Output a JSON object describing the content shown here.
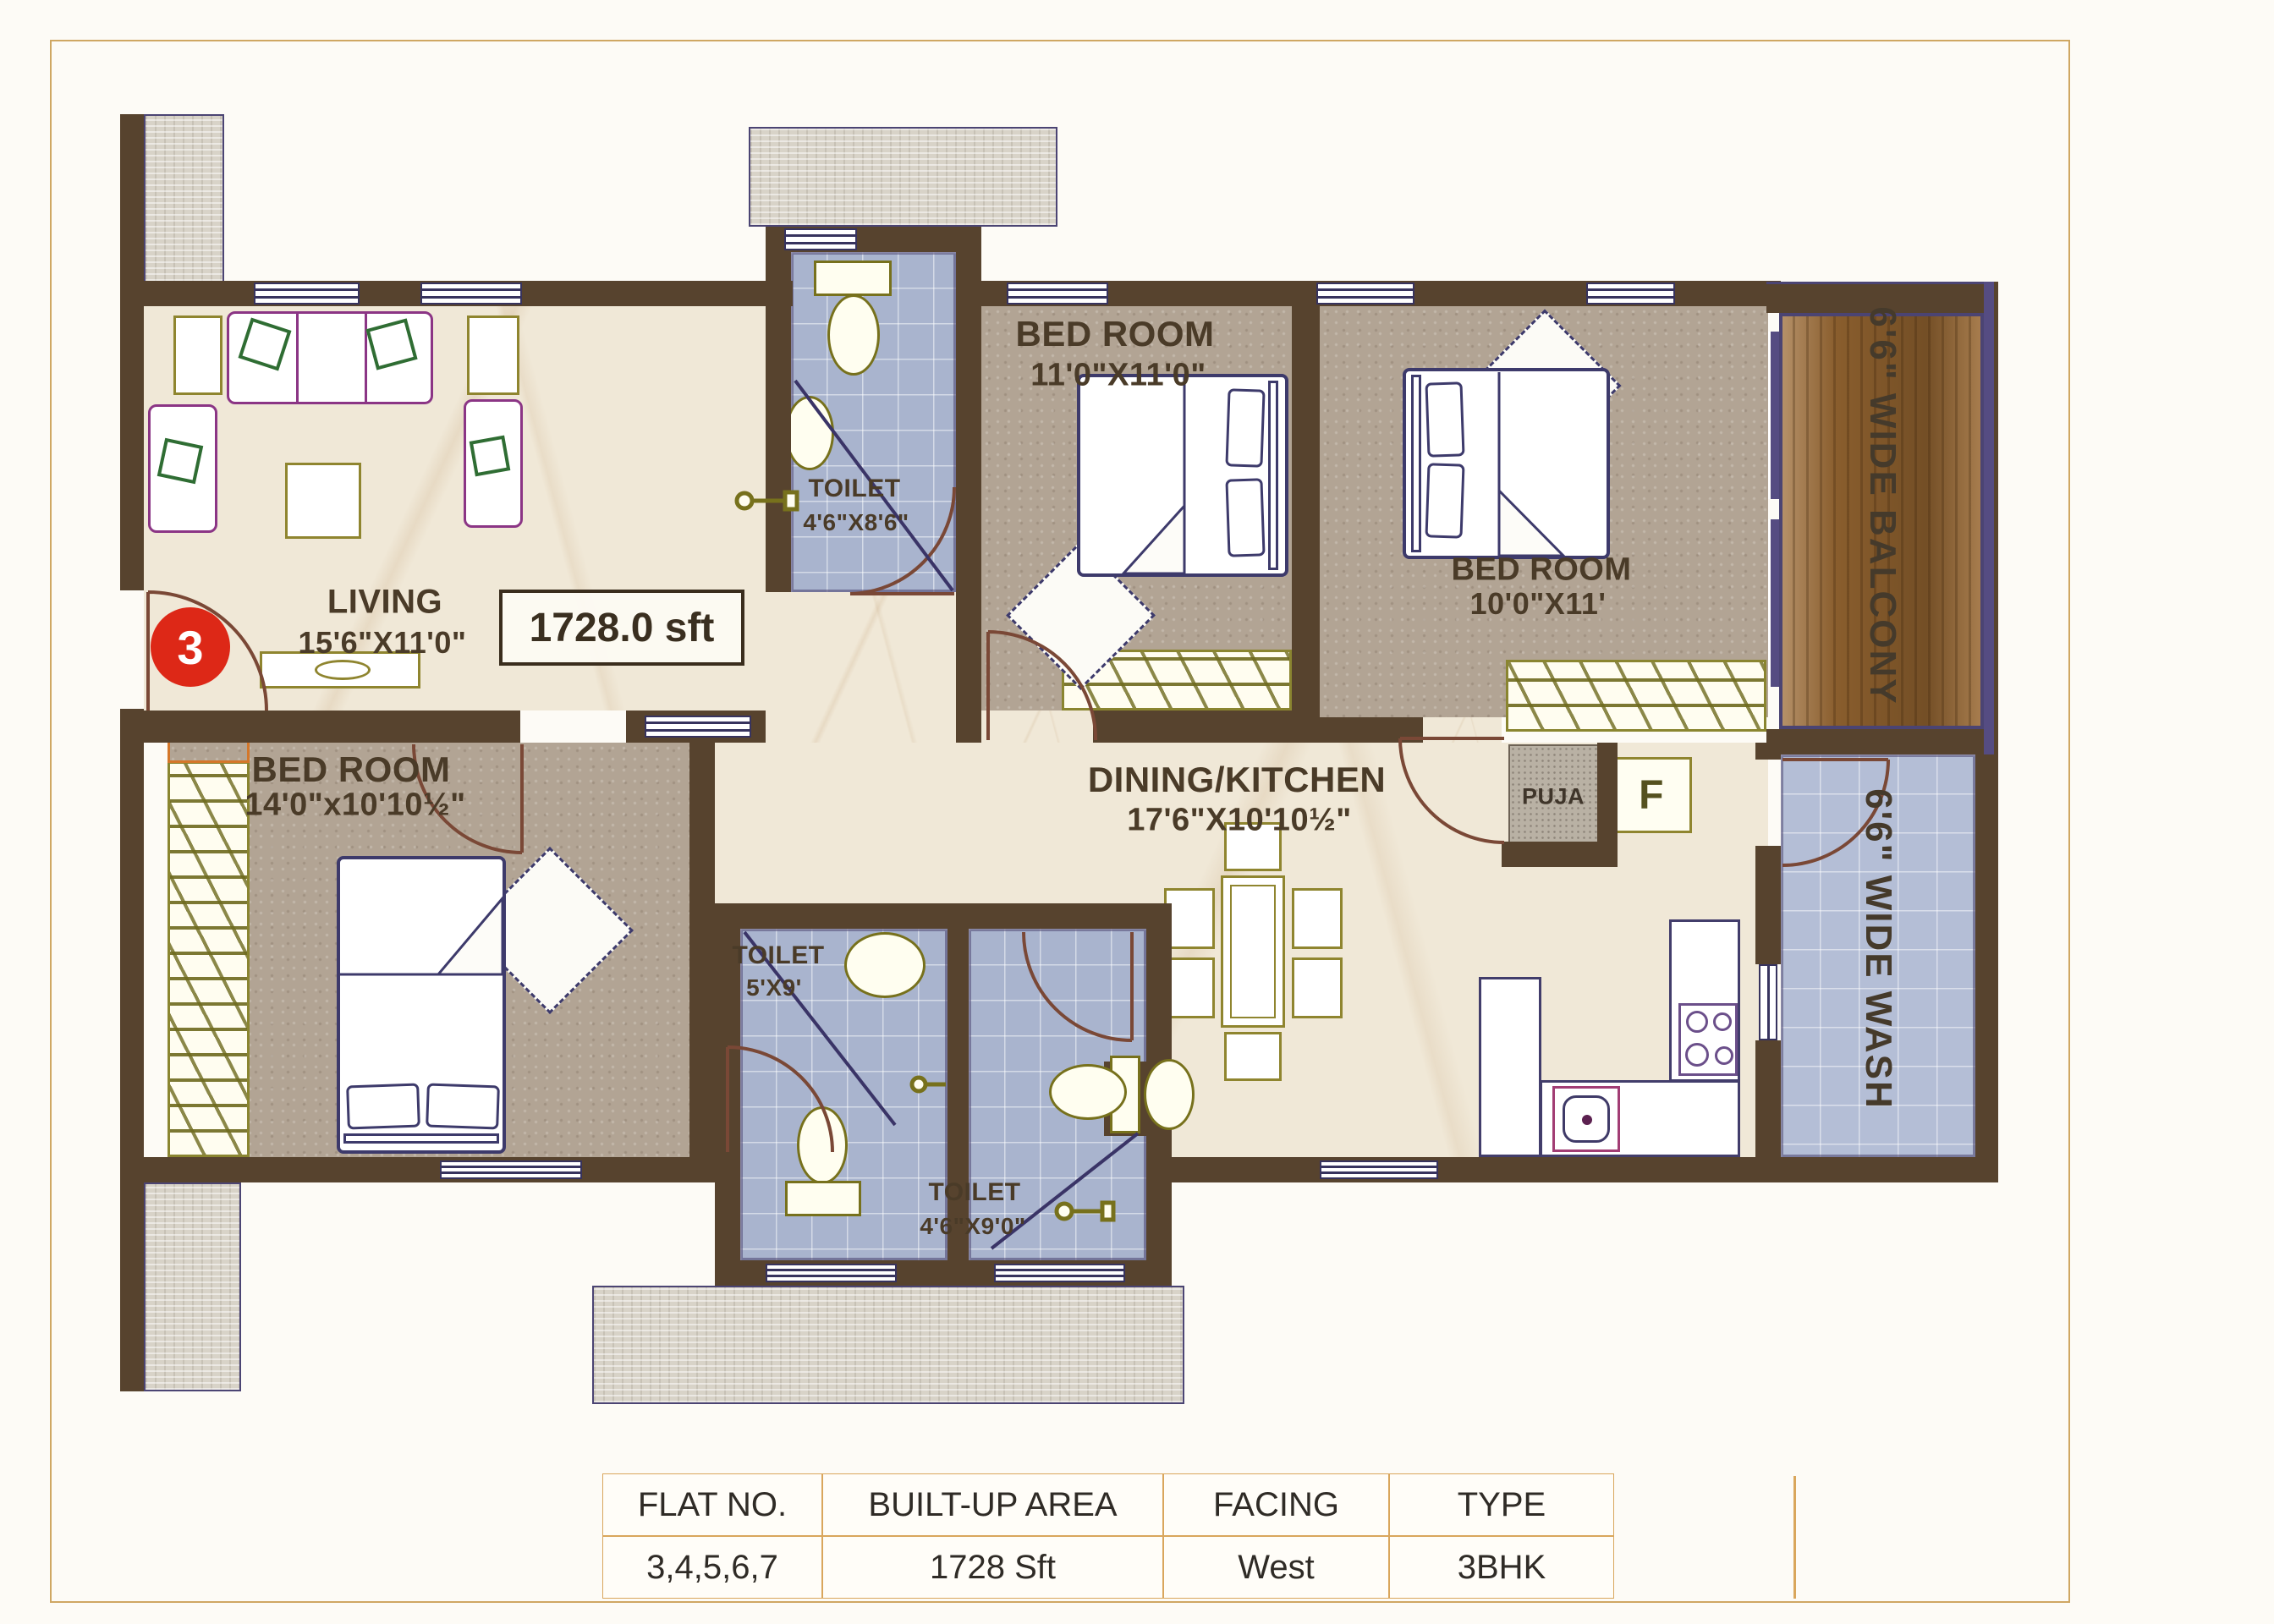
{
  "plan": {
    "badge": "3",
    "area": "1728.0 sft",
    "rooms": [
      {
        "id": "living",
        "name": "LIVING",
        "dims": "15'6\"X11'0\""
      },
      {
        "id": "bedroom-top",
        "name": "BED ROOM",
        "dims": "11'0\"X11'0\""
      },
      {
        "id": "bedroom-right",
        "name": "BED ROOM",
        "dims": "10'0\"X11'"
      },
      {
        "id": "bedroom-left",
        "name": "BED ROOM",
        "dims": "14'0\"x10'10½\""
      },
      {
        "id": "toilet-top",
        "name": "TOILET",
        "dims": "4'6\"X8'6\""
      },
      {
        "id": "toilet-mid",
        "name": "TOILET",
        "dims": "5'X9'"
      },
      {
        "id": "toilet-low",
        "name": "TOILET",
        "dims": "4'6\"X9'0\""
      },
      {
        "id": "dining",
        "name": "DINING/KITCHEN",
        "dims": "17'6\"X10'10½\""
      },
      {
        "id": "puja",
        "name": "PUJA",
        "dims": ""
      },
      {
        "id": "fridge",
        "name": "F",
        "dims": ""
      },
      {
        "id": "balcony",
        "name": "6'6\" WIDE BALCONY",
        "dims": ""
      },
      {
        "id": "wash",
        "name": "6'6\" WIDE WASH",
        "dims": ""
      }
    ]
  },
  "summary_table": {
    "headers": [
      "FLAT NO.",
      "BUILT-UP AREA",
      "FACING",
      "TYPE"
    ],
    "row": [
      "3,4,5,6,7",
      "1728 Sft",
      "West",
      "3BHK"
    ]
  },
  "colors": {
    "wall": "#57432e",
    "marble": "#f0e8d7",
    "tile_blue": "#a9b4ce",
    "wood": "#9c6a33",
    "accent_red": "#dd2817",
    "gold_border": "#d9a65c",
    "navy": "#3d3a6b",
    "olive": "#8f852f",
    "magenta": "#8b3585",
    "green": "#2f6d33"
  }
}
